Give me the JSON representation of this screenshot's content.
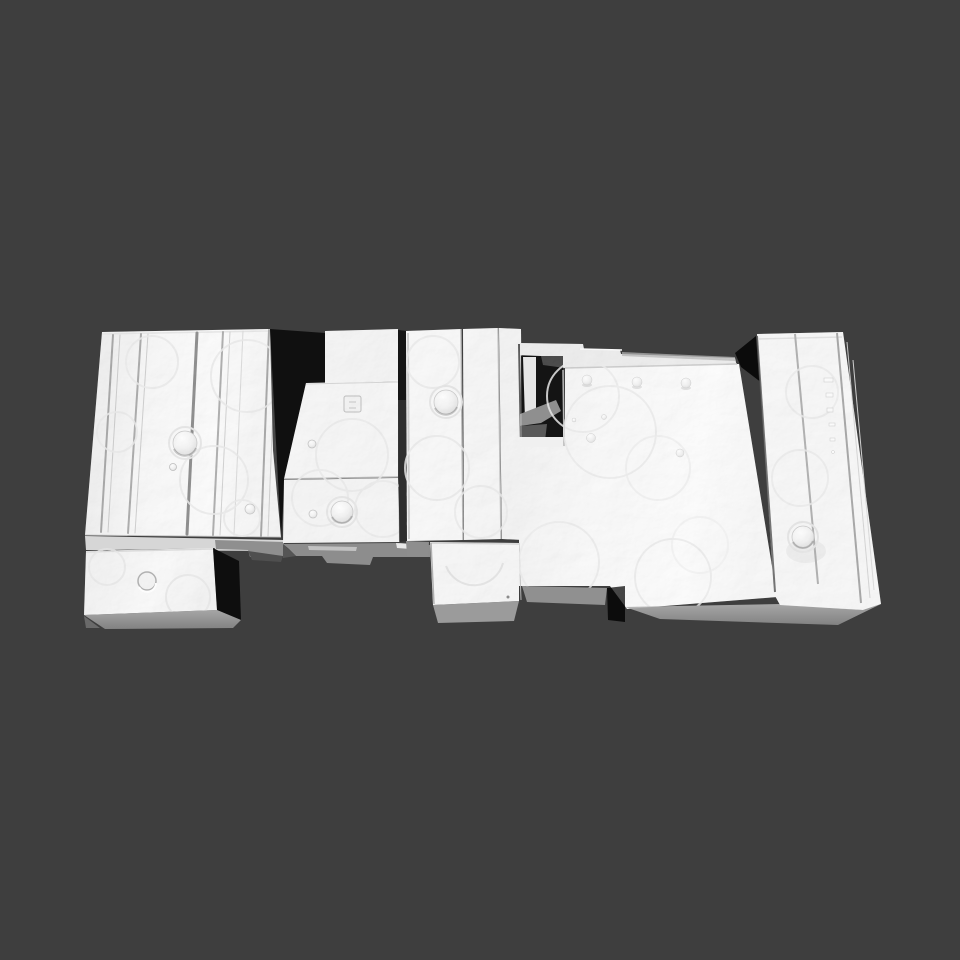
{
  "viewport": {
    "background_color": "#3e3e3e",
    "canvas_width": "960",
    "canvas_height": "960"
  },
  "model": {
    "description": "White 3D-scanned mesh of an assembly of rectangular machined blocks viewed from above at a slight perspective angle",
    "surface_color": "#f5f5f5",
    "side_shadow_color": "#101010",
    "underside_color": "#9b9b9b",
    "groove_line_color": "#979797",
    "faint_mark_color": "#e4e4e4",
    "components": [
      {
        "name": "left-grooved-block"
      },
      {
        "name": "front-left-small-block"
      },
      {
        "name": "middle-stepped-plates"
      },
      {
        "name": "center-column-slats"
      },
      {
        "name": "notched-recess"
      },
      {
        "name": "large-flat-plate"
      },
      {
        "name": "front-center-block"
      },
      {
        "name": "right-grooved-block"
      }
    ],
    "surface_features": {
      "dome_bumps": 5,
      "small_round_bumps": 12,
      "square_boss": 1,
      "crater_ring": 1,
      "embossed_dash_marks": 6
    }
  }
}
